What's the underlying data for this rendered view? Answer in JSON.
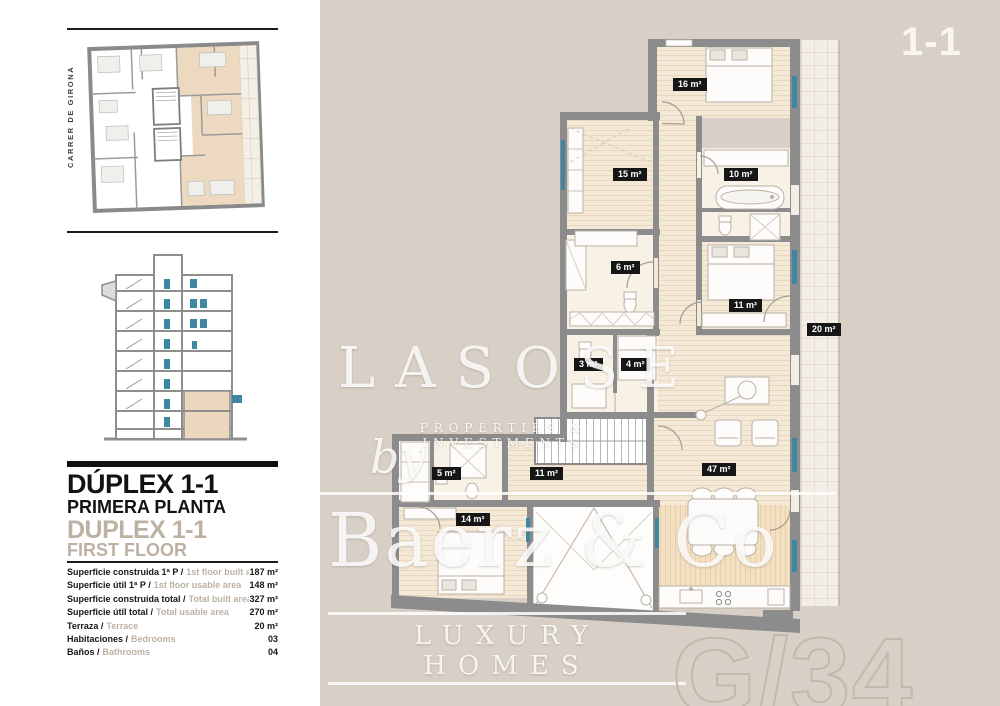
{
  "canvas": {
    "unit_badge": "1-1"
  },
  "sidebar": {
    "street": "CARRER DE GIRONA",
    "title_es": "DÚPLEX 1-1",
    "subtitle_es": "PRIMERA PLANTA",
    "title_en": "DUPLEX 1-1",
    "subtitle_en": "FIRST FLOOR",
    "specs": [
      {
        "es": "Superficie construida 1ª P /",
        "en": "1st floor built area",
        "value": "187 m²"
      },
      {
        "es": "Superficie útil 1ª P /",
        "en": "1st floor usable area",
        "value": "148 m²"
      },
      {
        "es": "Superficie construida total /",
        "en": "Total built area",
        "value": "327 m²"
      },
      {
        "es": "Superficie útil total /",
        "en": "Total usable area",
        "value": "270 m²"
      },
      {
        "es": "Terraza /",
        "en": "Terrace",
        "value": "20 m²"
      },
      {
        "es": "Habitaciones /",
        "en": "Bedrooms",
        "value": "03"
      },
      {
        "es": "Baños /",
        "en": "Bathrooms",
        "value": "04"
      }
    ]
  },
  "floor_plan": {
    "rooms": [
      {
        "name": "bedroom-top",
        "label": "16 m²"
      },
      {
        "name": "bedroom-left",
        "label": "15 m²"
      },
      {
        "name": "bathroom-top",
        "label": "10 m²"
      },
      {
        "name": "bathroom-mid",
        "label": "6 m²"
      },
      {
        "name": "bedroom-mid",
        "label": "11 m²"
      },
      {
        "name": "toilet-small",
        "label": "3 m²"
      },
      {
        "name": "laundry",
        "label": "4 m²"
      },
      {
        "name": "hall",
        "label": "11 m²"
      },
      {
        "name": "bathroom-lower",
        "label": "5 m²"
      },
      {
        "name": "bedroom-lower",
        "label": "14 m²"
      },
      {
        "name": "living-room",
        "label": "47 m²"
      },
      {
        "name": "terrace",
        "label": "20 m²"
      }
    ]
  },
  "watermark": {
    "brand": "LASOSE",
    "brand_tagline": "PROPERTIES & INVESTMENTS",
    "by": "by",
    "agency": "Baerz & Co",
    "agency_tagline": "LUXURY HOMES",
    "page_ref": "G/34"
  }
}
